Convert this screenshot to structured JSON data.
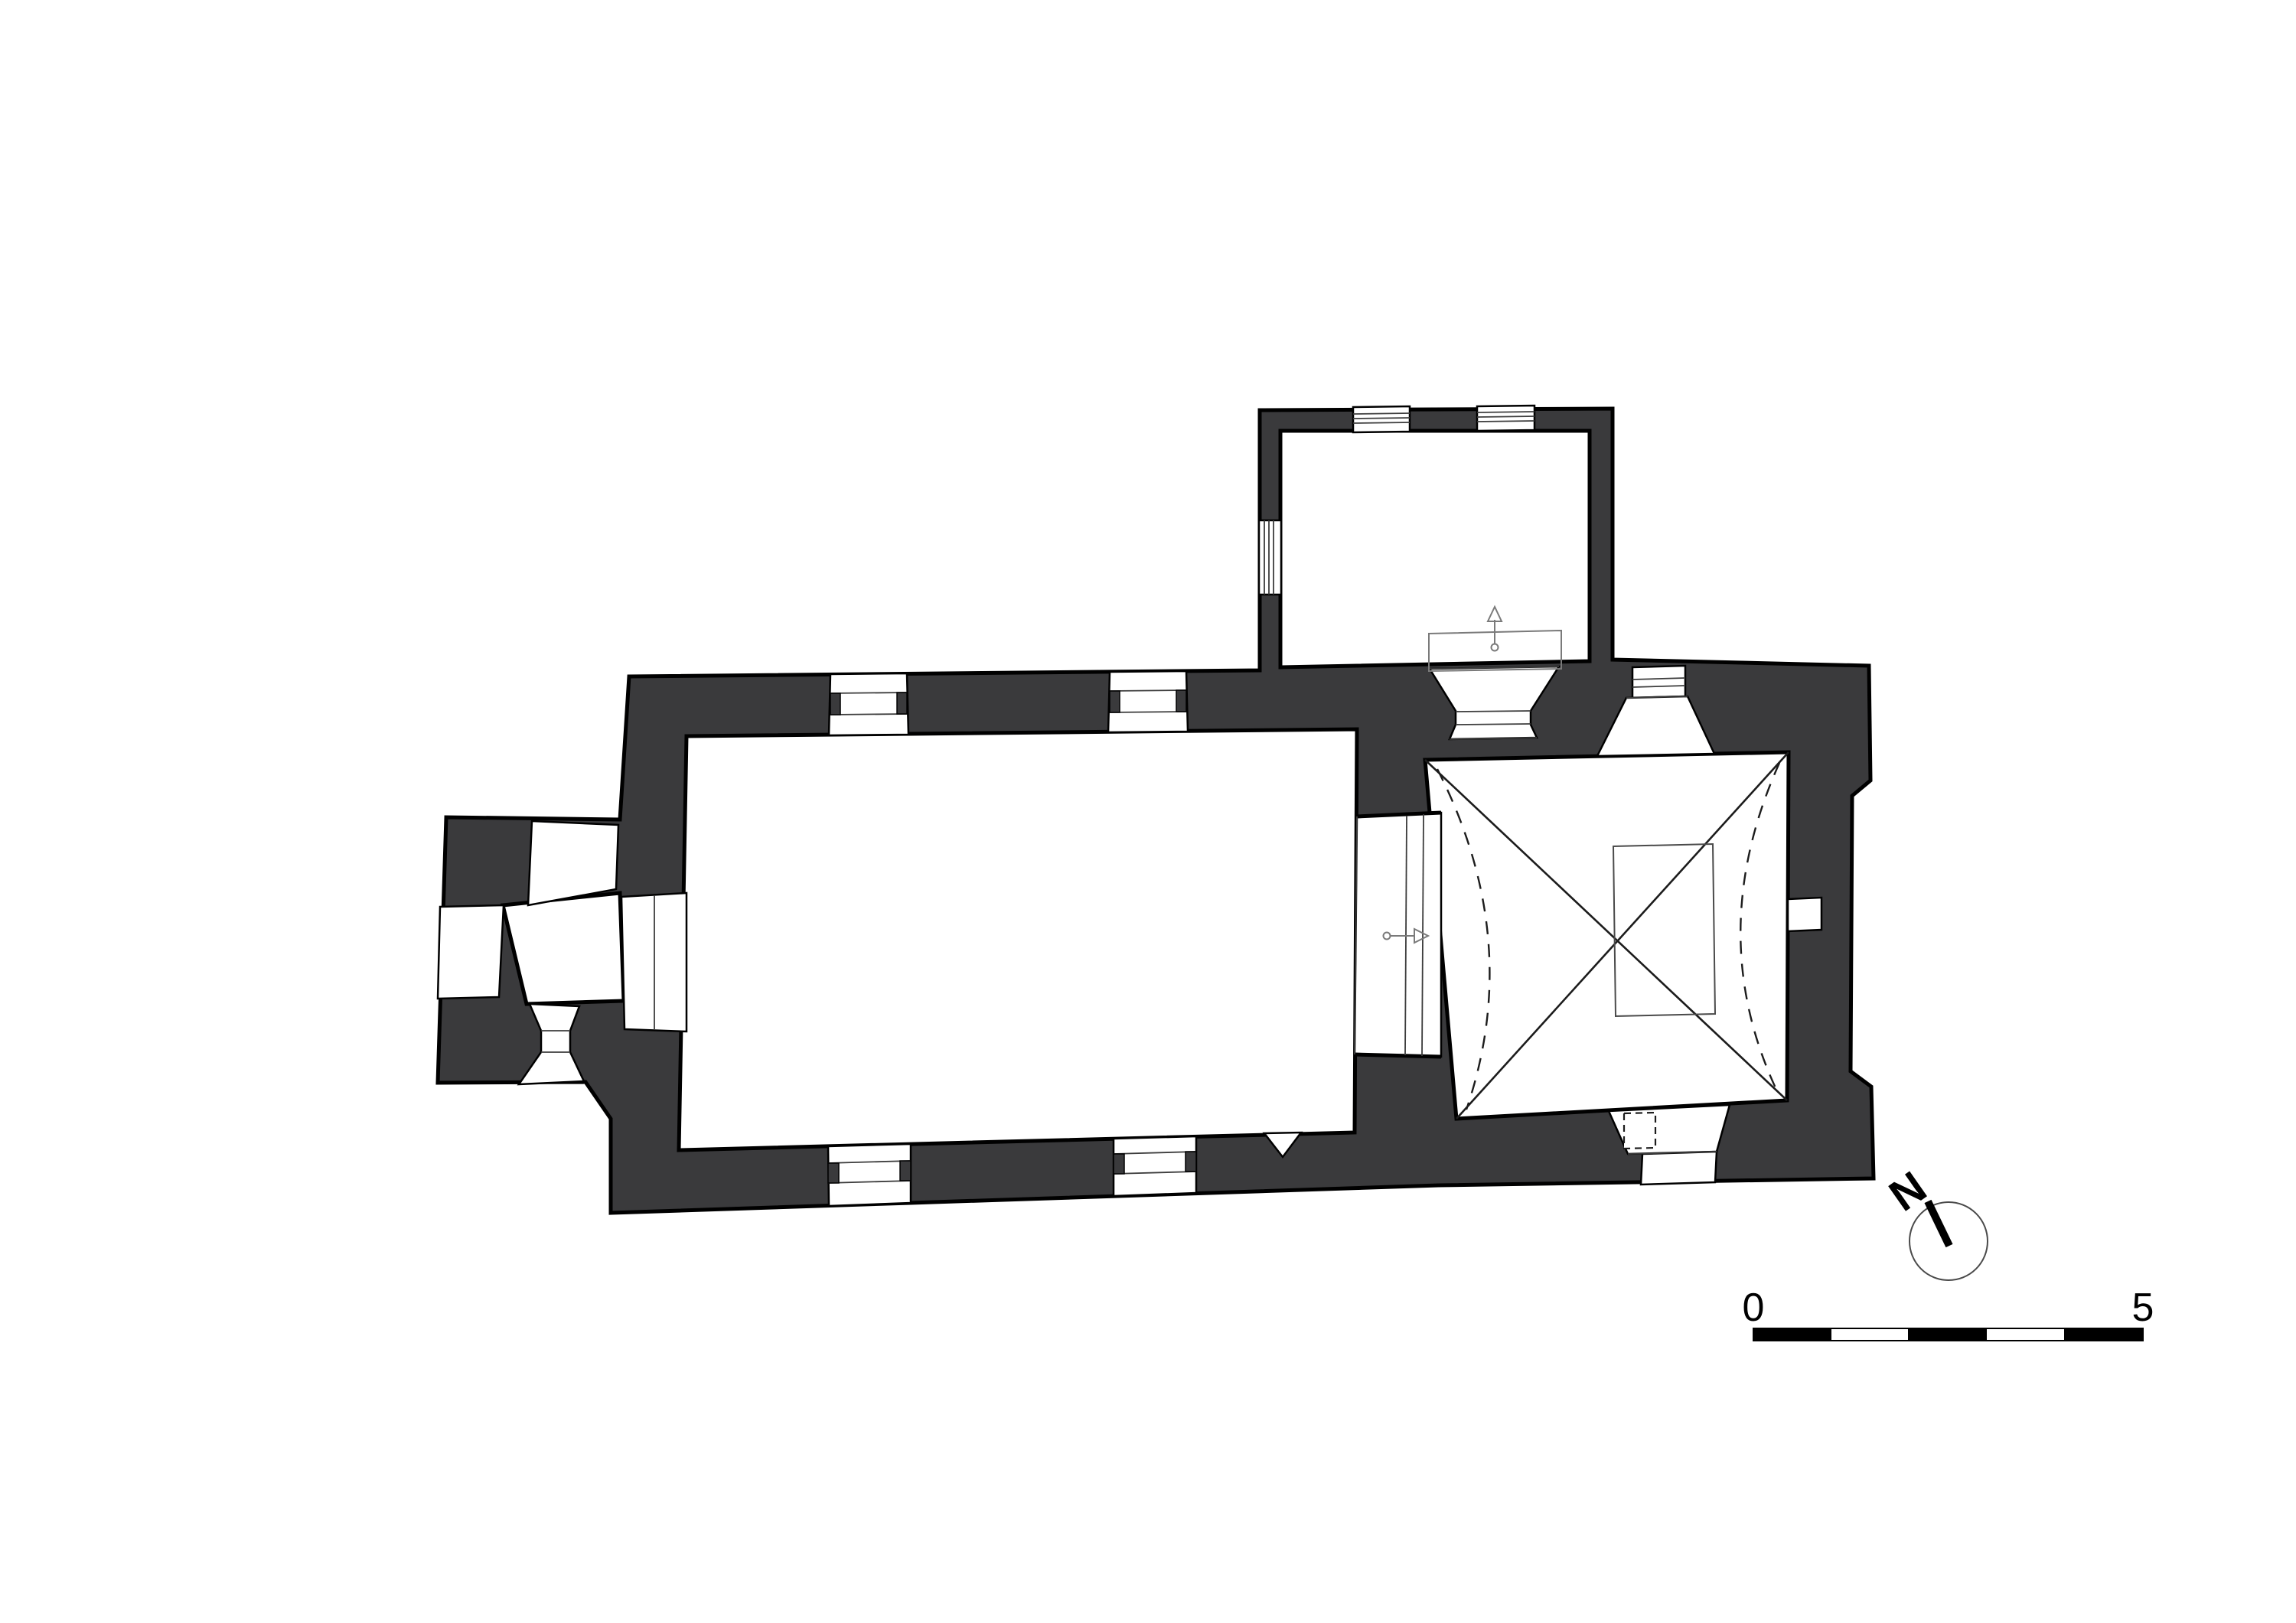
{
  "drawing": {
    "type": "architectural-floor-plan",
    "subject": "measured plan of a small single-nave church: west porch, rectangular nave, cross-vaulted square chancel with altar, north annex (sacristy)",
    "colors": {
      "wall_fill": "#3a3a3c",
      "outline": "#000000",
      "detail_line": "#3c3c3c",
      "background": "#ffffff"
    },
    "north_arrow": {
      "icon": "north-arrow-icon",
      "label": "N"
    },
    "scale_bar": {
      "start_label": "0",
      "end_label": "5",
      "segments": 5
    }
  }
}
